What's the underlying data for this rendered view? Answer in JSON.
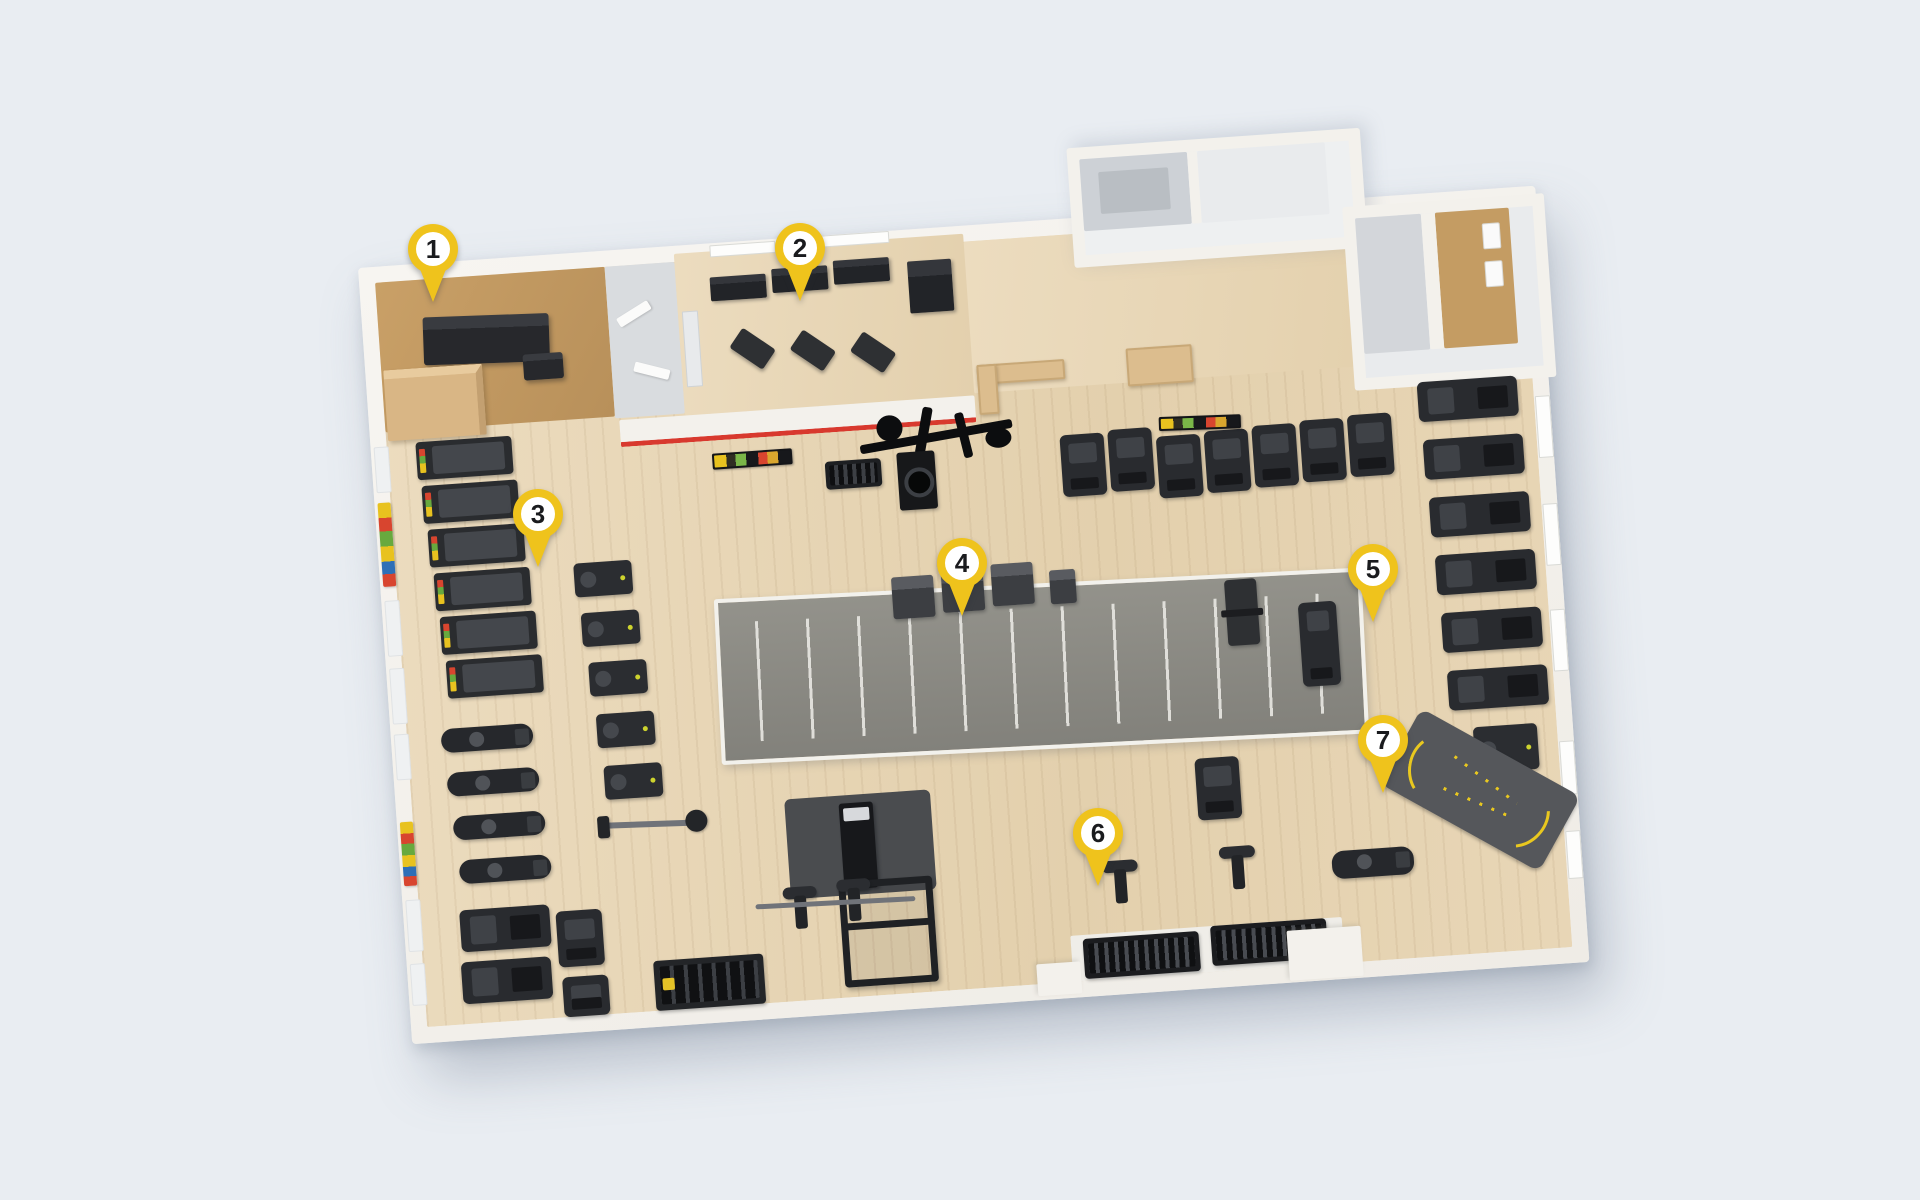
{
  "palette": {
    "background": "#e9edf2",
    "pin_yellow": "#efc31c",
    "pin_circle": "#ffffff",
    "pin_number": "#1a1b1e",
    "wall": "#f3f1ec",
    "wood": "#e8d6b8",
    "cork": "#c49c63",
    "turf": "#8d8c85",
    "turf_line": "#e7e6e1",
    "equipment": "#26282b",
    "red_stripe": "#d8392e",
    "counter_wood": "#dcbd8e",
    "mat": "#4a4c4f",
    "accent_lime": "#cdd32e"
  },
  "pins": [
    {
      "number": "1"
    },
    {
      "number": "2"
    },
    {
      "number": "3"
    },
    {
      "number": "4"
    },
    {
      "number": "5"
    },
    {
      "number": "6"
    },
    {
      "number": "7"
    }
  ]
}
